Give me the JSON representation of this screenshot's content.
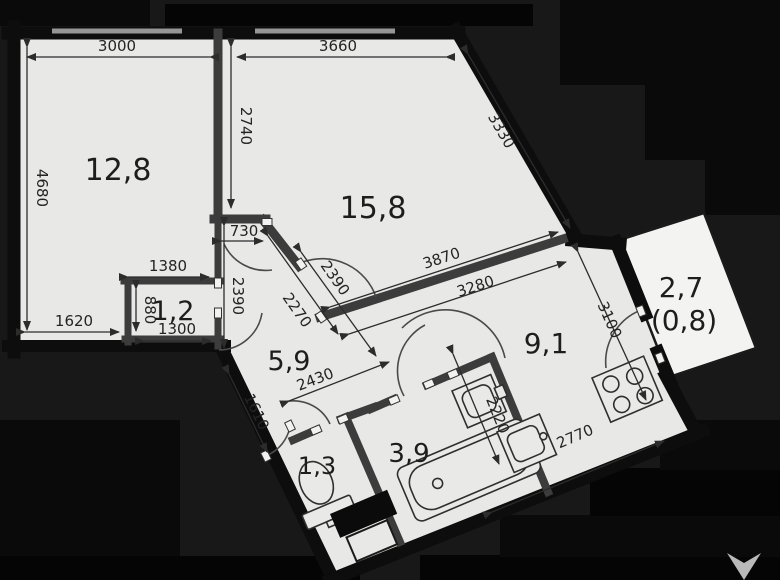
{
  "plan": {
    "title": "apartment-floor-plan",
    "rooms": [
      {
        "name": "room-living",
        "label": "12,8"
      },
      {
        "name": "room-bedroom",
        "label": "15,8"
      },
      {
        "name": "room-closet",
        "label": "1,2"
      },
      {
        "name": "room-hall",
        "label": "5,9"
      },
      {
        "name": "room-kitchen",
        "label": "9,1"
      },
      {
        "name": "room-balcony",
        "label": "2,7"
      },
      {
        "name": "room-balcony-reduced",
        "label": "(0,8)"
      },
      {
        "name": "room-wc",
        "label": "1,3"
      },
      {
        "name": "room-bathroom",
        "label": "3,9"
      }
    ],
    "dimensions": [
      {
        "label": "3000"
      },
      {
        "label": "3660"
      },
      {
        "label": "2740"
      },
      {
        "label": "4680"
      },
      {
        "label": "3330"
      },
      {
        "label": "730"
      },
      {
        "label": "2390"
      },
      {
        "label": "2270"
      },
      {
        "label": "2390"
      },
      {
        "label": "3870"
      },
      {
        "label": "3280"
      },
      {
        "label": "3100"
      },
      {
        "label": "2220"
      },
      {
        "label": "2770"
      },
      {
        "label": "2430"
      },
      {
        "label": "1610"
      },
      {
        "label": "1380"
      },
      {
        "label": "1620"
      },
      {
        "label": "880"
      },
      {
        "label": "1300"
      }
    ],
    "fixtures": [
      "toilet",
      "bathtub",
      "bathroom-sink",
      "kitchen-sink",
      "stove",
      "vent-duct"
    ],
    "icons": [
      "developer-logo-chevron"
    ],
    "colors": {
      "background": "#181818",
      "background_deep": "#050505",
      "floor": "#e8e8e6",
      "balcony_floor": "#f3f3f1",
      "outer_wall": "#0d0d0d",
      "inner_wall": "#3c3c3c",
      "dimension": "#2c2c2c",
      "window_sill": "#969696",
      "logo": "#cdcdcd"
    }
  }
}
